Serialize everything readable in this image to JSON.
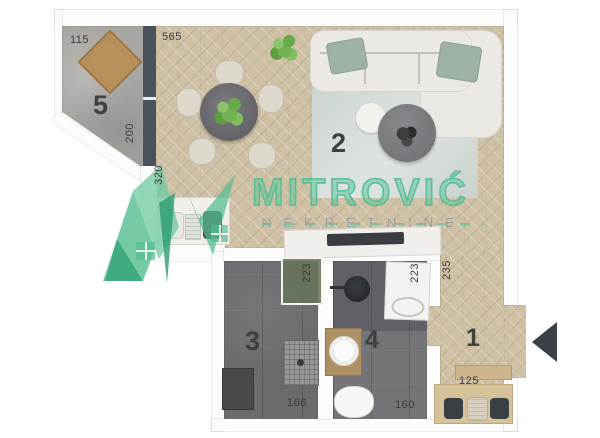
{
  "brand": {
    "name": "MITROVIĆ",
    "subtitle": "NEKRETNINE"
  },
  "colors": {
    "brand_green": "#54bd90",
    "wood_floor": "#cec0a5",
    "concrete_floor": "#a8a6a2",
    "tile_floor": "#6b6a6e",
    "dark_partition_wall": "#4a525c",
    "entrance_arrow": "#3a4045"
  },
  "floorplan": {
    "rooms": [
      {
        "number": "1",
        "name": "hallway"
      },
      {
        "number": "2",
        "name": "living-dining"
      },
      {
        "number": "3",
        "name": "bathroom"
      },
      {
        "number": "4",
        "name": "toilet-laundry"
      },
      {
        "number": "5",
        "name": "terrace"
      }
    ],
    "dimensions": {
      "terrace_top": "115",
      "terrace_side": "200",
      "living_top": "565",
      "living_side": "320",
      "bath_glass_side": "223",
      "laundry_side": "223",
      "hall_side": "235",
      "bath_bottom": "166",
      "wc_bottom": "160",
      "hall_bottom": "125"
    }
  }
}
